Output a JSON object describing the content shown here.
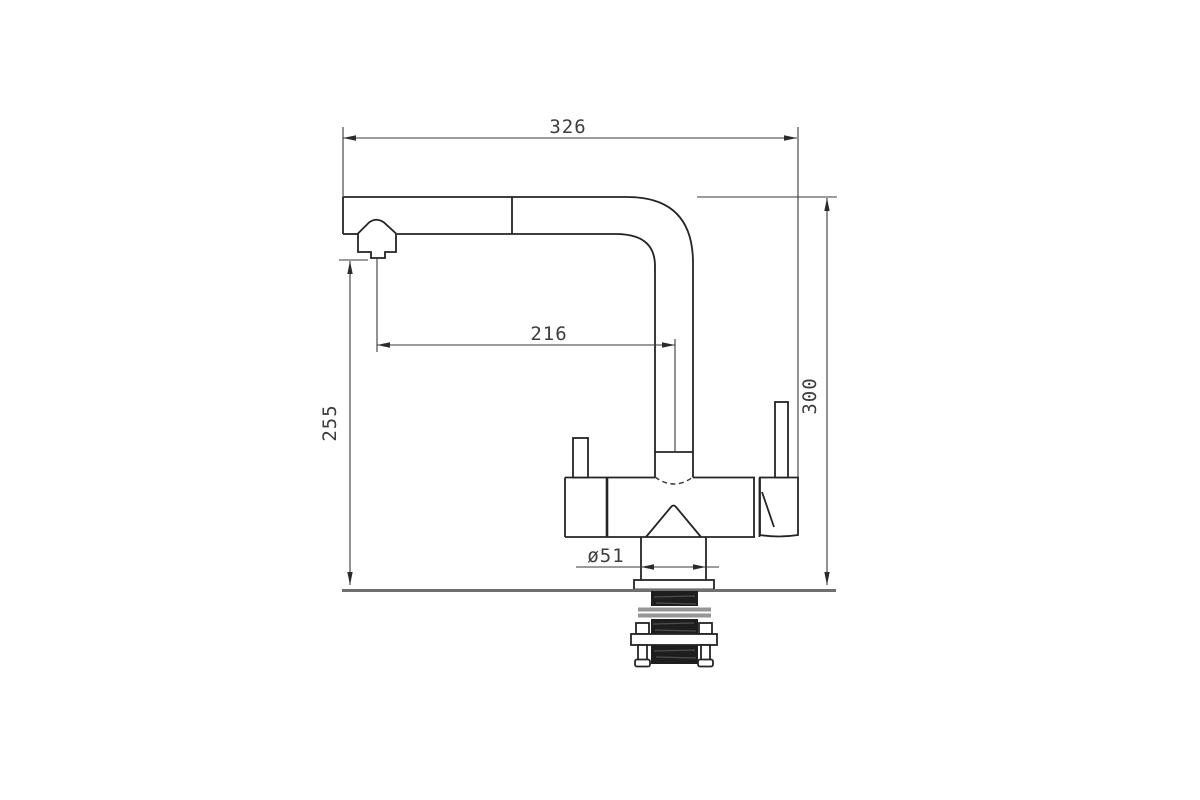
{
  "page": {
    "background": "#ffffff"
  },
  "drawing": {
    "subject": "pull-out-kitchen-mixer-faucet-side-elevation",
    "dimensions": {
      "overall_width_mm": "326",
      "spout_reach_mm": "216",
      "spout_height_mm": "255",
      "overall_height_mm": "300",
      "base_diameter_mm": "ø51"
    },
    "colors": {
      "line": "#242424",
      "dimension_line": "#3a3a3a",
      "label_text": "#3d3d3d",
      "mounting_surface": "#6f6f6f",
      "shank_fill": "#1e1e1e",
      "stripe": "#969696",
      "background": "#ffffff"
    }
  }
}
